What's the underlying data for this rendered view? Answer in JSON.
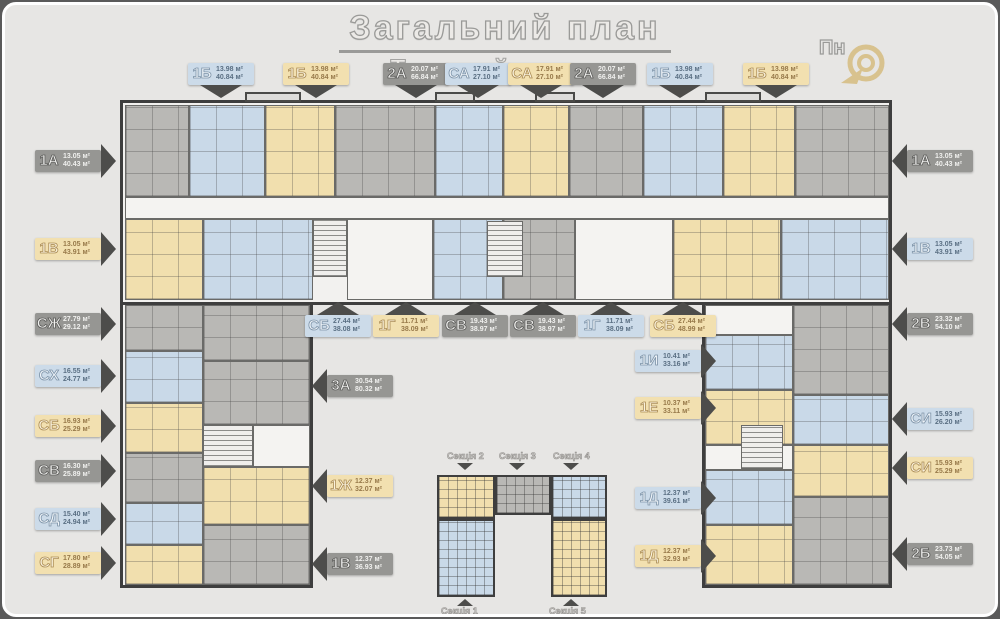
{
  "title": {
    "main": "Загальний план",
    "sub": "Типовий поверх"
  },
  "compass": {
    "label": "Пн",
    "icon": "north-spiral-arrow-icon"
  },
  "colors": {
    "blue": "#c9d9e8",
    "gold": "#f1dfae",
    "gray": "#b9b8b5",
    "wall": "#3e3e3e",
    "background": "#e7e6e4",
    "accent_gold": "#d8c28e"
  },
  "units_note": "м²",
  "tags": {
    "top": [
      {
        "code": "1Б",
        "area1": "13.98 м²",
        "area2": "40.84 м²",
        "color": "blue"
      },
      {
        "code": "1Б",
        "area1": "13.98 м²",
        "area2": "40.84 м²",
        "color": "gold"
      },
      {
        "code": "2А",
        "area1": "20.07 м²",
        "area2": "66.84 м²",
        "color": "gray"
      },
      {
        "code": "СА",
        "area1": "17.91 м²",
        "area2": "27.10 м²",
        "color": "blue"
      },
      {
        "code": "СА",
        "area1": "17.91 м²",
        "area2": "27.10 м²",
        "color": "gold"
      },
      {
        "code": "2А",
        "area1": "20.07 м²",
        "area2": "66.84 м²",
        "color": "gray"
      },
      {
        "code": "1Б",
        "area1": "13.98 м²",
        "area2": "40.84 м²",
        "color": "blue"
      },
      {
        "code": "1Б",
        "area1": "13.98 м²",
        "area2": "40.84 м²",
        "color": "gold"
      }
    ],
    "left": [
      {
        "code": "1А",
        "area1": "13.05 м²",
        "area2": "40.43 м²",
        "color": "gray"
      },
      {
        "code": "1В",
        "area1": "13.05 м²",
        "area2": "43.91 м²",
        "color": "gold"
      },
      {
        "code": "СЖ",
        "area1": "27.79 м²",
        "area2": "29.12 м²",
        "color": "gray"
      },
      {
        "code": "СХ",
        "area1": "16.55 м²",
        "area2": "24.77 м²",
        "color": "blue"
      },
      {
        "code": "СБ",
        "area1": "16.93 м²",
        "area2": "25.29 м²",
        "color": "gold"
      },
      {
        "code": "СВ",
        "area1": "16.30 м²",
        "area2": "25.89 м²",
        "color": "gray"
      },
      {
        "code": "СД",
        "area1": "15.40 м²",
        "area2": "24.94 м²",
        "color": "blue"
      },
      {
        "code": "СГ",
        "area1": "17.80 м²",
        "area2": "28.89 м²",
        "color": "gold"
      }
    ],
    "right": [
      {
        "code": "1А",
        "area1": "13.05 м²",
        "area2": "40.43 м²",
        "color": "gray"
      },
      {
        "code": "1В",
        "area1": "13.05 м²",
        "area2": "43.91 м²",
        "color": "blue"
      },
      {
        "code": "2В",
        "area1": "23.32 м²",
        "area2": "54.10 м²",
        "color": "gray"
      },
      {
        "code": "СИ",
        "area1": "15.93 м²",
        "area2": "26.20 м²",
        "color": "blue"
      },
      {
        "code": "СИ",
        "area1": "15.93 м²",
        "area2": "25.29 м²",
        "color": "gold"
      },
      {
        "code": "2Б",
        "area1": "23.73 м²",
        "area2": "54.05 м²",
        "color": "gray"
      }
    ],
    "middle": [
      {
        "code": "СБ",
        "area1": "27.44 м²",
        "area2": "38.08 м²",
        "color": "blue"
      },
      {
        "code": "1Г",
        "area1": "11.71 м²",
        "area2": "38.09 м²",
        "color": "gold"
      },
      {
        "code": "СВ",
        "area1": "19.43 м²",
        "area2": "38.97 м²",
        "color": "gray"
      },
      {
        "code": "СВ",
        "area1": "19.43 м²",
        "area2": "38.97 м²",
        "color": "gray"
      },
      {
        "code": "1Г",
        "area1": "11.71 м²",
        "area2": "38.09 м²",
        "color": "blue"
      },
      {
        "code": "СБ",
        "area1": "27.44 м²",
        "area2": "48.99 м²",
        "color": "gold"
      }
    ],
    "inner_right": [
      {
        "code": "1И",
        "area1": "10.41 м²",
        "area2": "33.16 м²",
        "color": "blue"
      },
      {
        "code": "1Е",
        "area1": "10.37 м²",
        "area2": "33.11 м²",
        "color": "gold"
      },
      {
        "code": "1Д",
        "area1": "12.37 м²",
        "area2": "39.61 м²",
        "color": "blue"
      },
      {
        "code": "1Д",
        "area1": "12.37 м²",
        "area2": "32.93 м²",
        "color": "gold"
      }
    ],
    "inner_left": [
      {
        "code": "3А",
        "area1": "30.54 м²",
        "area2": "80.32 м²",
        "color": "gray"
      },
      {
        "code": "1Ж",
        "area1": "12.37 м²",
        "area2": "32.07 м²",
        "color": "gold"
      },
      {
        "code": "1В",
        "area1": "12.37 м²",
        "area2": "36.93 м²",
        "color": "gray"
      }
    ]
  },
  "sections": {
    "top": [
      "Секція 2",
      "Секція 3",
      "Секція 4"
    ],
    "bottom": [
      "Секція 1",
      "Секція 5"
    ]
  }
}
